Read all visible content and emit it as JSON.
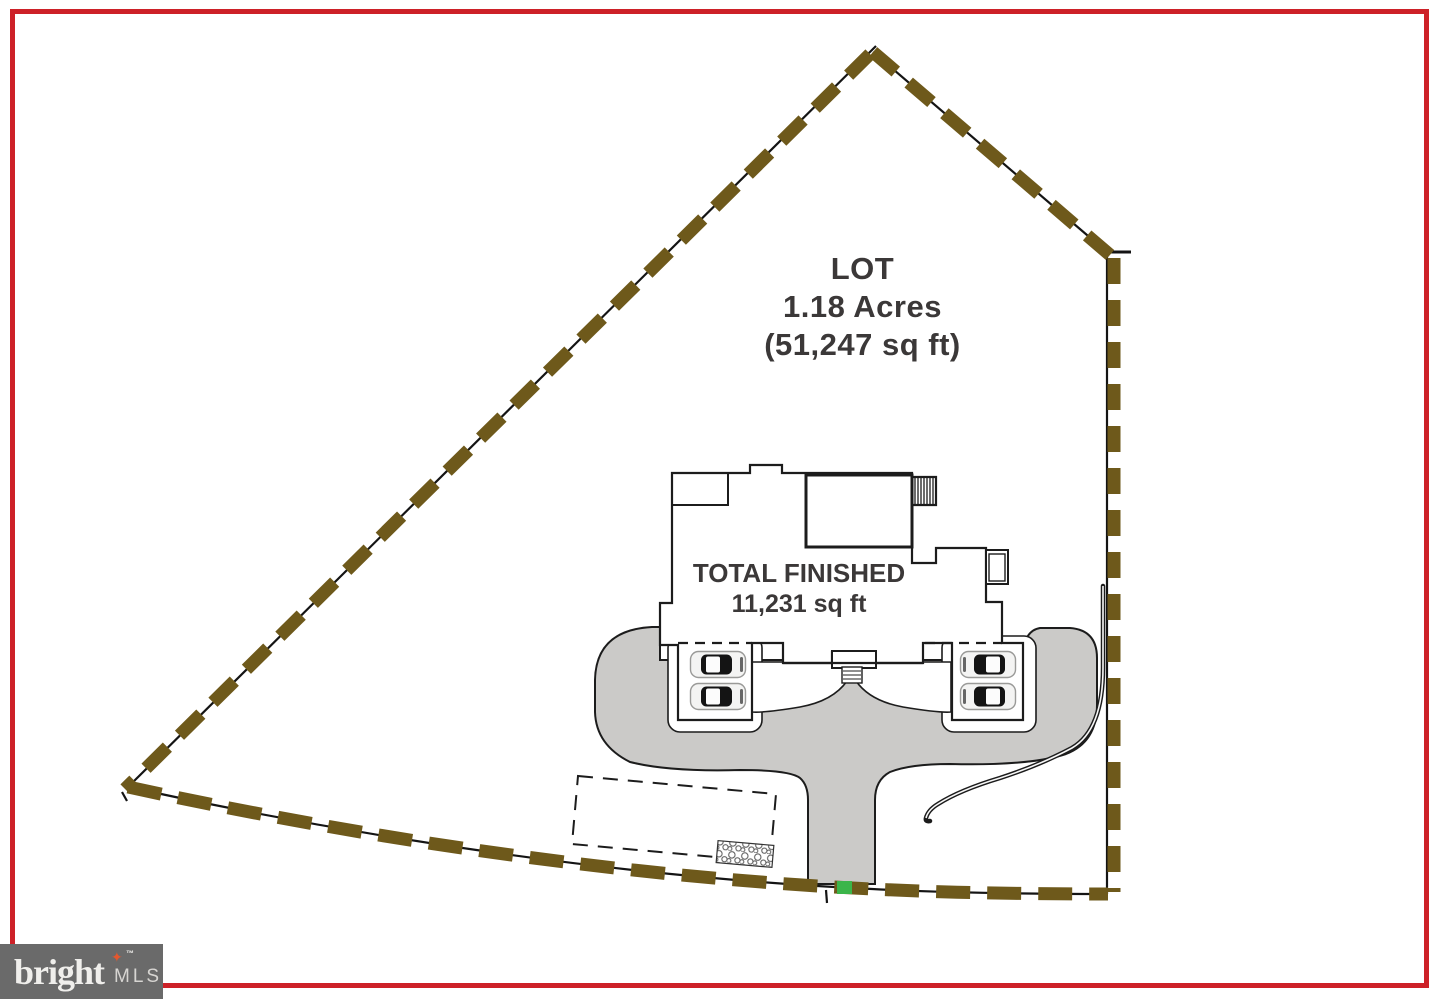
{
  "labels": {
    "lot": {
      "line1": "LOT",
      "line2": "1.18 Acres",
      "line3": "(51,247 sq ft)"
    },
    "house": {
      "line1": "TOTAL FINISHED",
      "line2": "11,231 sq ft"
    }
  },
  "branding": {
    "logo_text": "bright",
    "logo_star": "✦",
    "logo_tm": "™",
    "logo_suffix": "MLS"
  },
  "colors": {
    "page_border": "#cd2128",
    "boundary_dash": "#6e591b",
    "boundary_line": "#141414",
    "driveway_fill": "#cbcac8",
    "outline": "#1c1c1c",
    "label_text": "#3b3838",
    "logo_box": "#6a6a6a",
    "logo_text": "#f0efec",
    "logo_star_color": "#e4572e",
    "logo_suffix_color": "#d7d5d2",
    "survey_marker": "#3bb54a"
  }
}
